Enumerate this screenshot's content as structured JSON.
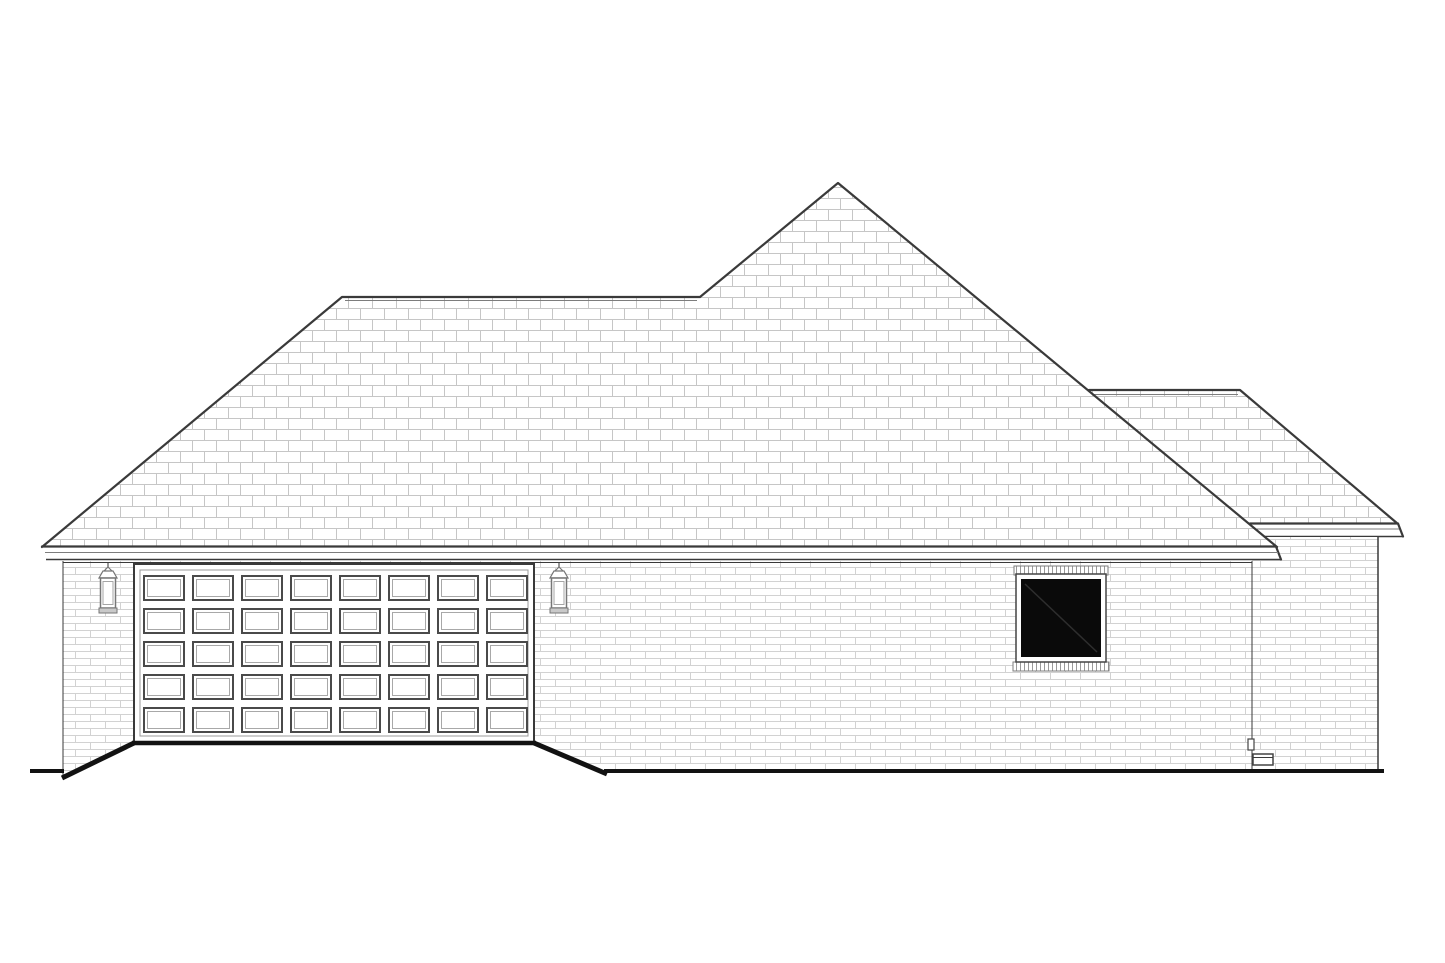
{
  "canvas": {
    "width": 1445,
    "height": 963,
    "background": "#ffffff"
  },
  "palette": {
    "ink": "#3a3a3a",
    "ink_strong": "#121212",
    "ink_soft": "#7d7d7d",
    "shingle_line": "#c6c6c6",
    "brick_line": "#d2d2d2",
    "soldier_line": "#9a9a9a",
    "fixture": "#767676",
    "glass": "#0a0a0a",
    "glass_reflection": "#2e2e2e",
    "surface": "#ffffff"
  },
  "scene": {
    "kind": "house-side-elevation-line-drawing",
    "roof": {
      "style": "hip",
      "shingle_unit": {
        "width": 24,
        "height": 11
      },
      "main_ridge": {
        "x1": 342,
        "x2": 700,
        "y": 297
      },
      "peak": {
        "x": 838,
        "y": 183
      },
      "eave_left": {
        "x": 42,
        "y": 547
      },
      "eave_right": {
        "x": 1277,
        "y": 547
      },
      "rear_wing": {
        "ridge": {
          "x1": 1089,
          "x2": 1240,
          "y": 390
        },
        "eave": {
          "x1": 1251,
          "x2": 1398,
          "y": 524
        }
      }
    },
    "walls": {
      "brick_unit": {
        "width": 30,
        "height": 7
      },
      "main": {
        "left": 63,
        "right": 1252,
        "top": 561,
        "bottom": 770
      },
      "rear_wing": {
        "left": 1252,
        "right": 1378,
        "top": 537,
        "bottom": 770
      }
    },
    "garage_door": {
      "x": 134,
      "y": 564,
      "width": 400,
      "height": 178,
      "inner_frame": {
        "x": 140,
        "y": 570,
        "width": 388,
        "height": 166
      },
      "panel_grid": {
        "rows": 5,
        "cols": 8,
        "x0": 144,
        "y0": 576,
        "panel_w": 40,
        "panel_h": 24,
        "pitch_x": 49,
        "pitch_y": 33
      }
    },
    "lanterns": [
      {
        "cx": 108
      },
      {
        "cx": 559
      }
    ],
    "window": {
      "lintel": {
        "x": 1014,
        "y": 566,
        "width": 94,
        "height": 9
      },
      "frame": {
        "x": 1016,
        "y": 574,
        "width": 90,
        "height": 88
      },
      "glass": {
        "x": 1021,
        "y": 579,
        "width": 80,
        "height": 78
      },
      "reflection": {
        "x1": 1025,
        "y1": 584,
        "x2": 1097,
        "y2": 652
      },
      "sill": {
        "x": 1013,
        "y": 662,
        "width": 96,
        "height": 9
      }
    },
    "ground": {
      "y": 771,
      "left_segment": {
        "x1": 30,
        "x2": 64
      },
      "main_segment": {
        "x1": 604,
        "x2": 1384
      },
      "door_threshold": {
        "x1": 132,
        "x2": 536,
        "y": 743
      },
      "driveway_edges": [
        {
          "x1": 134,
          "y1": 743,
          "x2": 62,
          "y2": 778
        },
        {
          "x1": 534,
          "y1": 743,
          "x2": 607,
          "y2": 774
        }
      ]
    },
    "utility": {
      "meter": {
        "x": 1248,
        "y": 739,
        "width": 6,
        "height": 11
      },
      "vent_box": {
        "x": 1253,
        "y": 754,
        "width": 20,
        "height": 11
      }
    }
  }
}
